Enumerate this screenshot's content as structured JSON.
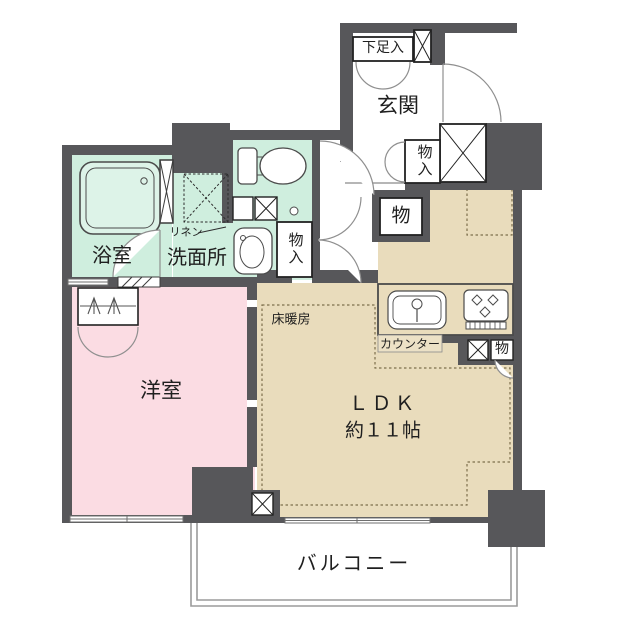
{
  "labels": {
    "shoe_cabinet": "下足入",
    "entrance": "玄関",
    "entrance_closet": "物入",
    "hall_closet": "物",
    "washroom": "洗面所",
    "linen": "リネン",
    "washroom_closet": "物入",
    "bathroom": "浴室",
    "bedroom": "洋室",
    "ldk_name": "ＬＤＫ",
    "ldk_size": "約１１帖",
    "floor_heating": "床暖房",
    "counter": "カウンター",
    "kitchen_closet": "物",
    "balcony": "バルコニー"
  },
  "colors": {
    "wall": "#57575a",
    "wet_area": "#cfeede",
    "bedroom": "#fbdce3",
    "ldk": "#e9dcbc",
    "counter_strip": "#ece1c6",
    "balcony_line": "#9b9b9b"
  }
}
